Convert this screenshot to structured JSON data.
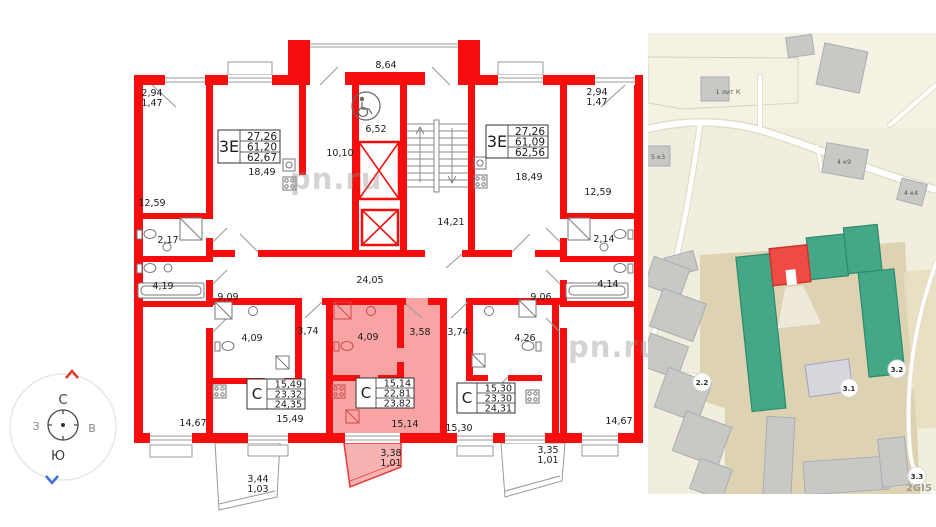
{
  "watermark": {
    "text": "pn.ru"
  },
  "compass": {
    "north": "С",
    "south": "Ю",
    "west": "З",
    "east": "В"
  },
  "floorplan": {
    "apartments": [
      {
        "id": "left-3e",
        "type": "3Е",
        "rows": [
          "27,26",
          "61,20",
          "62,67"
        ]
      },
      {
        "id": "right-3e",
        "type": "3Е",
        "rows": [
          "27,26",
          "61,09",
          "62,56"
        ]
      },
      {
        "id": "left-studio",
        "type": "С",
        "rows": [
          "15,49",
          "23,32",
          "24,35"
        ]
      },
      {
        "id": "center-studio",
        "type": "С",
        "rows": [
          "15,14",
          "22,81",
          "23,82"
        ]
      },
      {
        "id": "right-studio",
        "type": "С",
        "rows": [
          "15,30",
          "23,30",
          "24,31"
        ]
      }
    ],
    "rooms": {
      "balcony_tl_a": "2,94",
      "balcony_tl_b": "1,47",
      "balcony_tr_a": "2,94",
      "balcony_tr_b": "1,47",
      "bedroom_left": "12,59",
      "bedroom_right": "12,59",
      "wc_left": "2,17",
      "wc_right": "2,14",
      "bath_left": "4,19",
      "bath_right": "4,14",
      "room_bottom_left": "14,67",
      "room_bottom_right": "14,67",
      "hall_left": "9,09",
      "hall_right": "9,06",
      "corridor_top": "8,64",
      "lobby": "6,52",
      "kitchen_left": "10,10",
      "stairs": "14,21",
      "corridor_main": "24,05",
      "living_left": "18,49",
      "living_right": "18,49",
      "studio_left_bath": "4,09",
      "studio_center_bath": "4,09",
      "studio_right_bath": "4,26",
      "studio_left_hall": "3,74",
      "studio_right_hall": "3,74",
      "studio_center_hall": "3,58",
      "studio_left_room": "15,49",
      "studio_center_room": "15,14",
      "studio_right_room": "15,30",
      "balcony_bl_a": "3,44",
      "balcony_bl_b": "1,03",
      "balcony_bc_a": "3,38",
      "balcony_bc_b": "1,01",
      "balcony_br_a": "3,35",
      "balcony_br_b": "1,01"
    }
  },
  "map": {
    "provider": "2GIS",
    "building_labels": {
      "lit_k": "1 лит К",
      "k5_3": "5 к3",
      "k4_9": "4 к9",
      "k4_4": "4 к4"
    },
    "badges": {
      "b_2_2": "2.2",
      "b_3_1": "3.1",
      "b_3_2": "3.2",
      "b_3_3": "3.3"
    }
  }
}
